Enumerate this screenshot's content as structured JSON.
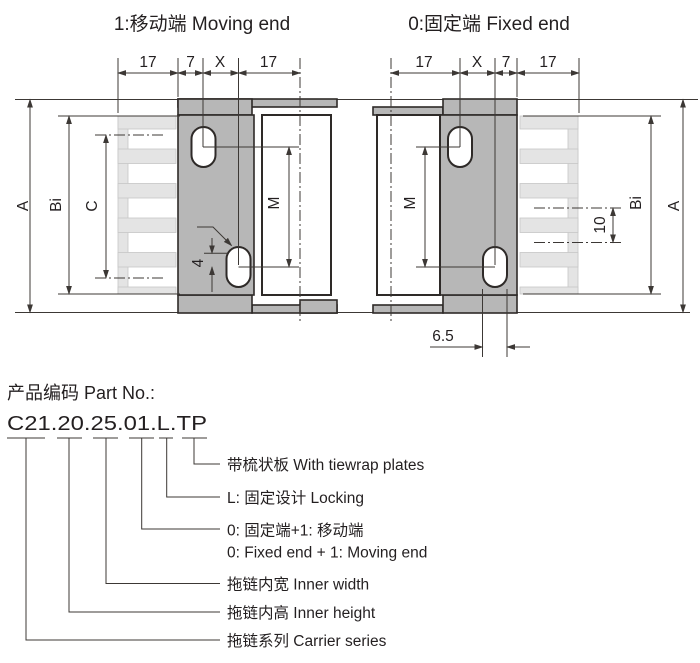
{
  "titles": {
    "moving_end": "1:移动端 Moving end",
    "fixed_end": "0:固定端 Fixed end"
  },
  "dims": {
    "seventeen": "17",
    "seven": "7",
    "x": "X",
    "a": "A",
    "bi": "Bi",
    "c": "C",
    "m": "M",
    "four": "4",
    "ten": "10",
    "six_five": "6.5"
  },
  "part": {
    "heading": "产品编码 Part No.:",
    "number": "C21.20.25.01.L.TP"
  },
  "legend": {
    "tiewrap": "带梳状板 With tiewrap plates",
    "locking": "L: 固定设计 Locking",
    "ends_cn": "0: 固定端+1: 移动端",
    "ends_en": "0: Fixed end + 1: Moving end",
    "inner_width": "拖链内宽 Inner width",
    "inner_height": "拖链内高 Inner height",
    "series": "拖链系列 Carrier series"
  },
  "colors": {
    "plate": "#b7b7b7",
    "comb": "#e4e4e4",
    "line": "#3c3835",
    "outline": "#2e2a28",
    "text": "#231f20"
  }
}
